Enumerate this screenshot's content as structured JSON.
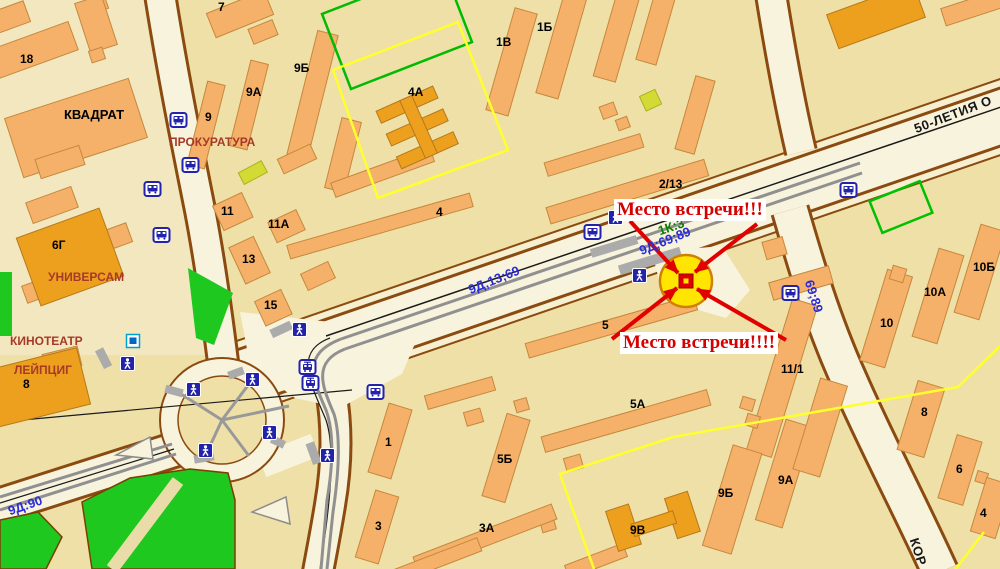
{
  "annotations": {
    "top": "Место встречи!!!",
    "bottom": "Место встречи!!!!"
  },
  "street_names": {
    "avenue": "50-ЛЕТИЯ О",
    "side_street": "КОР"
  },
  "bus_routes": {
    "avenue_west": "9Д;13;69",
    "at_meeting_point": "9Д;69;89",
    "side_road": "69;89",
    "southwest": "9Д:90"
  },
  "block_code": "1К:3",
  "places": {
    "block": "КВАДРАТ",
    "prosecutor": "ПРОКУРАТУРА",
    "supermarket": "УНИВЕРСАМ",
    "cinema_type": "КИНОТЕАТР",
    "cinema_name": "ЛЕЙПЦИГ"
  },
  "buildings": [
    "18",
    "7",
    "9Б",
    "9А",
    "9",
    "11",
    "11А",
    "13",
    "15",
    "6Г",
    "8",
    "4А",
    "4",
    "1В",
    "1Б",
    "2/13",
    "5",
    "5А",
    "5Б",
    "1",
    "3",
    "3А",
    "9В",
    "9Б",
    "9А",
    "11/1",
    "10",
    "10А",
    "10Б",
    "8",
    "6",
    "4"
  ],
  "icons": {
    "bus_stop": "bus-front-glyph",
    "tram_stop": "tram-front-glyph",
    "pedestrian_crossing": "walking-person-glyph",
    "poi": "blue-square-glyph"
  },
  "colors": {
    "background": "#EFE0A8",
    "road": "#F8F3DC",
    "road_edge": "#8A4A10",
    "building": "#F5B169",
    "building_dark": "#EDA01E",
    "green_area": "#1EC81E",
    "route_text": "#2B2BD8",
    "annotation_red": "#D60000",
    "marker_yellow": "#FFE500"
  }
}
